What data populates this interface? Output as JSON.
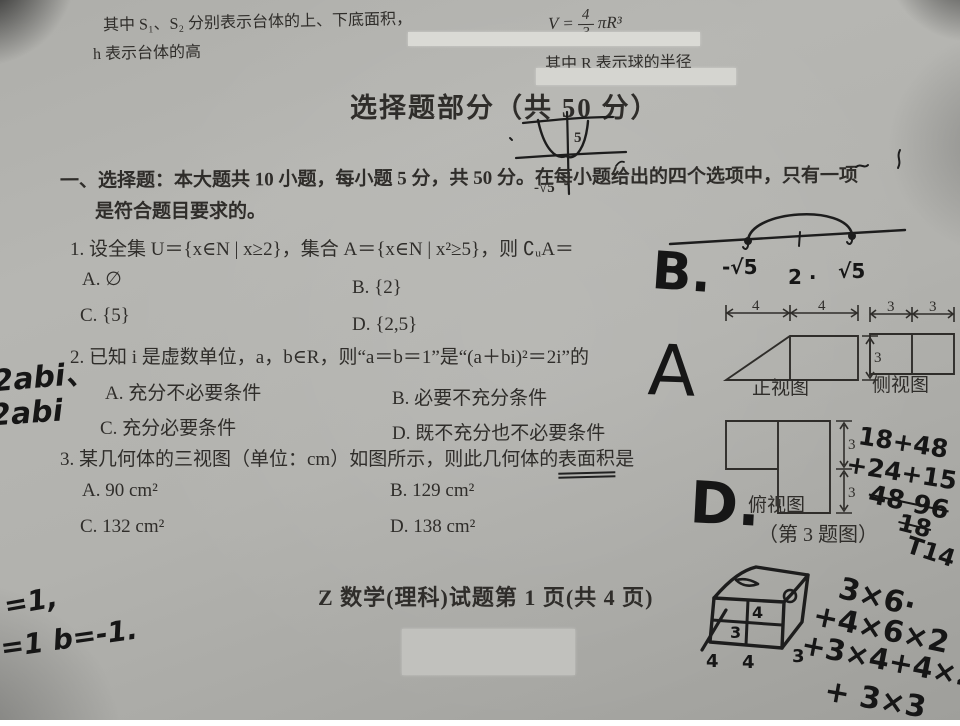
{
  "document": {
    "formulas": {
      "frustum_line1": "其中 S₁、S₂ 分别表示台体的上、下底面积，",
      "frustum_line2": "h 表示台体的高",
      "sphere_v": "V =",
      "sphere_frac_num": "4",
      "sphere_frac_den": "3",
      "sphere_tail": "πR³",
      "sphere_note": "其中 R 表示球的半径"
    },
    "section_title": "选择题部分（共 50 分）",
    "intro_line1": "一、选择题：本大题共 10 小题，每小题 5 分，共 50 分。在每小题给出的四个选项中，只有一项",
    "intro_line2": "是符合题目要求的。",
    "q1": {
      "stem": "1. 设全集 U＝{x∈N | x≥2}，集合 A＝{x∈N | x²≥5}，则 ∁ᵤA＝",
      "opt_a": "A. ∅",
      "opt_b": "B. {2}",
      "opt_c": "C. {5}",
      "opt_d": "D. {2,5}"
    },
    "q2": {
      "stem": "2. 已知 i 是虚数单位，a，b∈R，则“a＝b＝1”是“(a＋bi)²＝2i”的",
      "opt_a": "A. 充分不必要条件",
      "opt_b": "B. 必要不充分条件",
      "opt_c": "C. 充分必要条件",
      "opt_d": "D. 既不充分也不必要条件"
    },
    "q3": {
      "stem_pre": "3. 某几何体的三视图（单位：cm）如图所示，则此几何体的",
      "stem_underlined": "表面积",
      "stem_post": "是",
      "opt_a": "A. 90 cm²",
      "opt_b": "B. 129 cm²",
      "opt_c": "C. 132 cm²",
      "opt_d": "D. 138 cm²"
    },
    "figure": {
      "front_label": "正视图",
      "side_label": "侧视图",
      "top_label": "俯视图",
      "caption": "（第 3 题图）",
      "front_dim_left": "4",
      "front_dim_right": "4",
      "front_height": "3",
      "side_dim_left": "3",
      "side_dim_right": "3",
      "top_dim_upper": "3",
      "top_dim_lower": "3"
    },
    "footer": "Z 数学(理科)试题第 1 页(共 4 页)"
  },
  "handwriting": {
    "q1_answer": "B.",
    "numberline_left": "-√5",
    "numberline_mid": "2 ·",
    "numberline_right": "√5",
    "graph_label_inner": "5",
    "graph_label_left": "-√5",
    "q2_answer": "A",
    "q2_margin_line1": "2abi、",
    "q2_margin_line2": "2abi",
    "q3_answer": "D.",
    "surface_calc_line1": "18+48",
    "surface_calc_line2": "+24+15",
    "surface_calc_line3": "48 96",
    "surface_calc_line4": "18",
    "bottom_left_line1": "=1,",
    "bottom_left_line2": "=1 b=-1.",
    "cube_calc_line1": "3×6·",
    "cube_calc_line2": "+4×6×2",
    "cube_calc_line3": "+3×4+4×2+",
    "cube_calc_line4": "+ 3×3",
    "cube_calc_extra": "T14",
    "cube_dim_a": "4",
    "cube_dim_b": "4",
    "cube_dim_c": "3",
    "cube_dim_d": "3",
    "cube_dim_e": "4"
  }
}
